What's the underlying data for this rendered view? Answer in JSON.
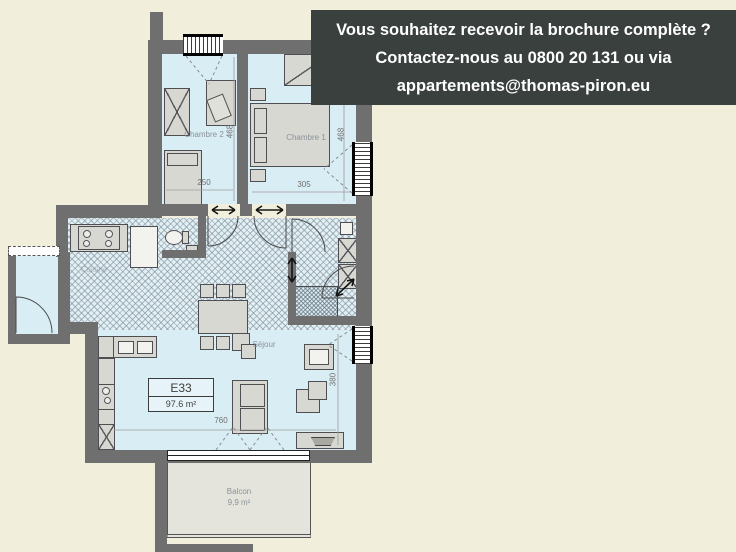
{
  "banner": {
    "line1": "Vous souhaitez recevoir la brochure complète ?",
    "line2": "Contactez-nous au 0800 20 131 ou via",
    "line3": "appartements@thomas-piron.eu"
  },
  "plan": {
    "unit_code": "E33",
    "unit_area": "97.6 m²",
    "labels": {
      "chambre2": "Chambre 2",
      "chambre1": "Chambre 1",
      "sejour": "Séjour",
      "cuisine": "Cuisine",
      "balcon": "Balcon",
      "balcon_area": "9,9 m²"
    },
    "dims": {
      "chambre2_width": "250",
      "chambre1_width": "305",
      "chambre2_depth": "468",
      "chambre1_depth": "468",
      "sejour_depth": "380",
      "sejour_width": "760"
    }
  },
  "colors": {
    "background": "#f1eedb",
    "wall": "#6f6f6f",
    "floor": "#d9edf4",
    "banner_bg": "#3a403d",
    "banner_text": "#ffffff"
  }
}
